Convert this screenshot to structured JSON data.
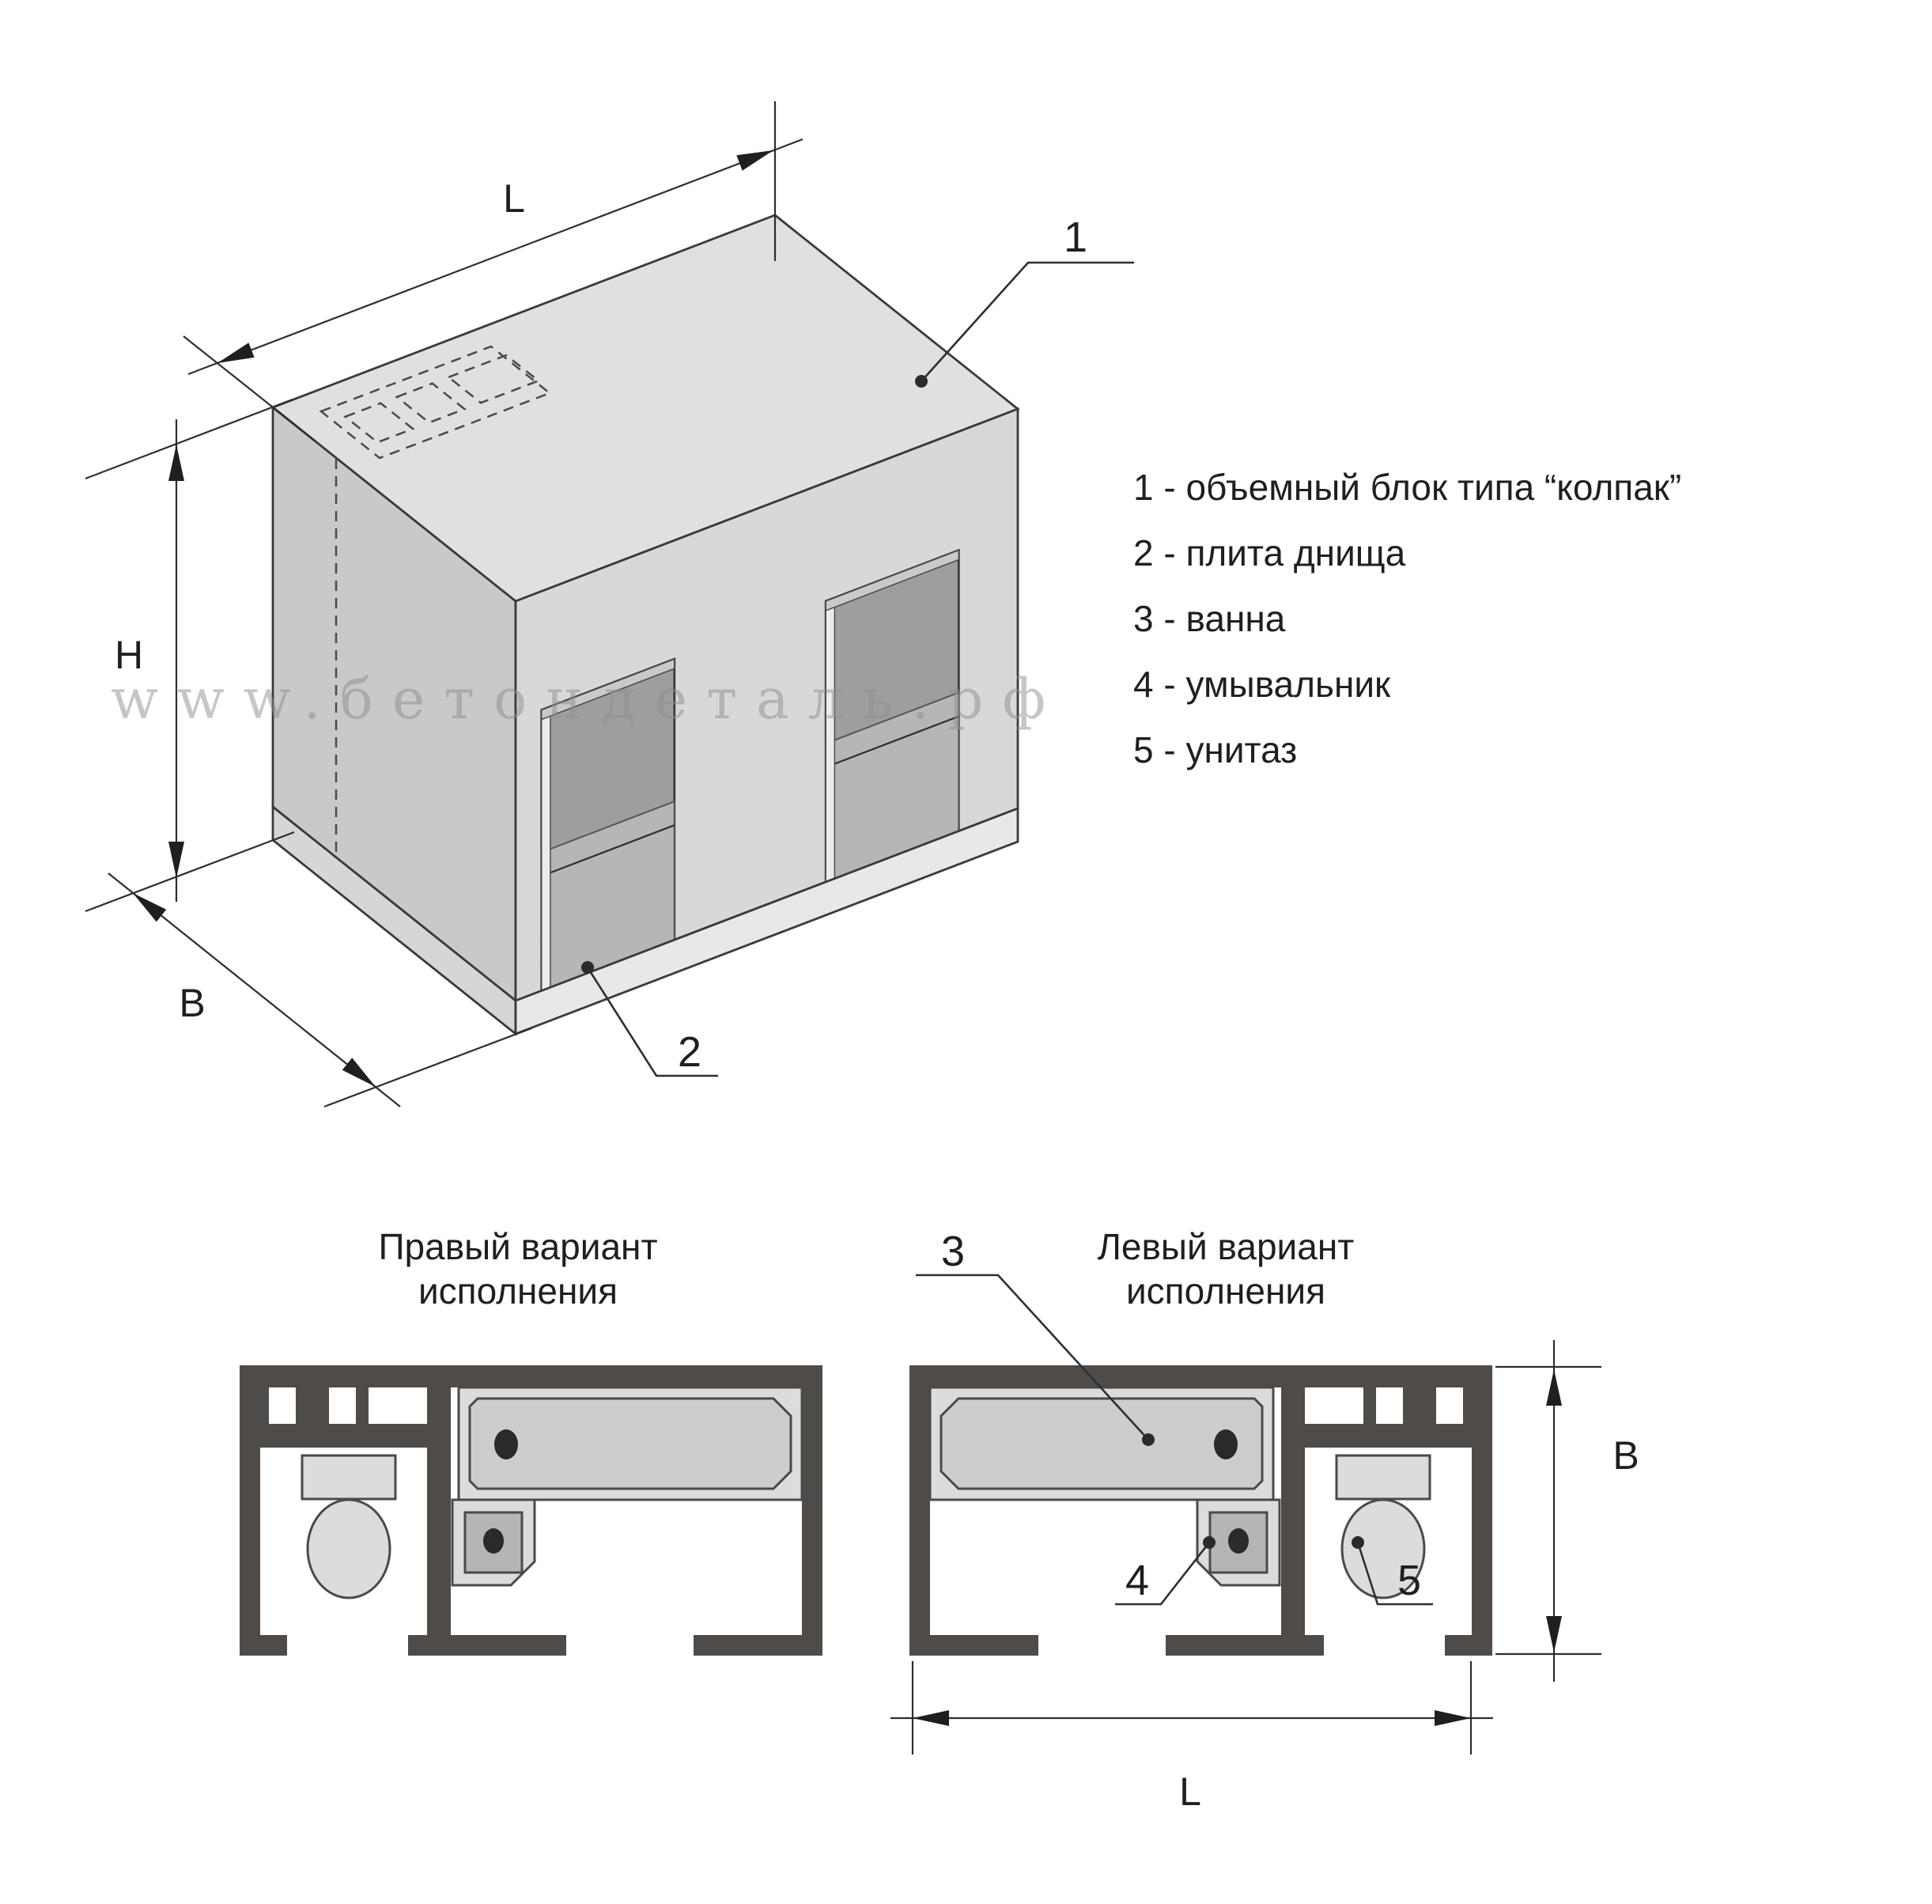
{
  "watermark": "www.бетондеталь.рф",
  "legend": {
    "items": [
      {
        "text": "1 - объемный блок типа “колпак”"
      },
      {
        "text": "2 - плита днища"
      },
      {
        "text": "3 - ванна"
      },
      {
        "text": "4 - умывальник"
      },
      {
        "text": "5 - унитаз"
      }
    ]
  },
  "iso_view": {
    "callout_block": "1",
    "callout_bottom_slab": "2",
    "dim_length": "L",
    "dim_height": "H",
    "dim_width": "B"
  },
  "plans": {
    "right_variant": {
      "title_line1": "Правый вариант",
      "title_line2": "исполнения"
    },
    "left_variant": {
      "title_line1": "Левый вариант",
      "title_line2": "исполнения",
      "callout_bath": "3",
      "callout_sink": "4",
      "callout_toilet": "5",
      "dim_width": "B",
      "dim_length": "L"
    }
  },
  "colors": {
    "wall": "#4e4b49",
    "face_top": "#e0e0e0",
    "face_front": "#d8d8d8",
    "face_left": "#c9c9c9",
    "door_interior": "#9e9e9e",
    "door_far_wall": "#b6b6b6",
    "slab_front": "#e8e8e8",
    "slab_left": "#d6d6d6",
    "fixture_fill": "#dcdcdc",
    "tub_fill": "#cdcdcd",
    "sink_inner": "#b5b5b5",
    "drain": "#4a4a4a"
  }
}
